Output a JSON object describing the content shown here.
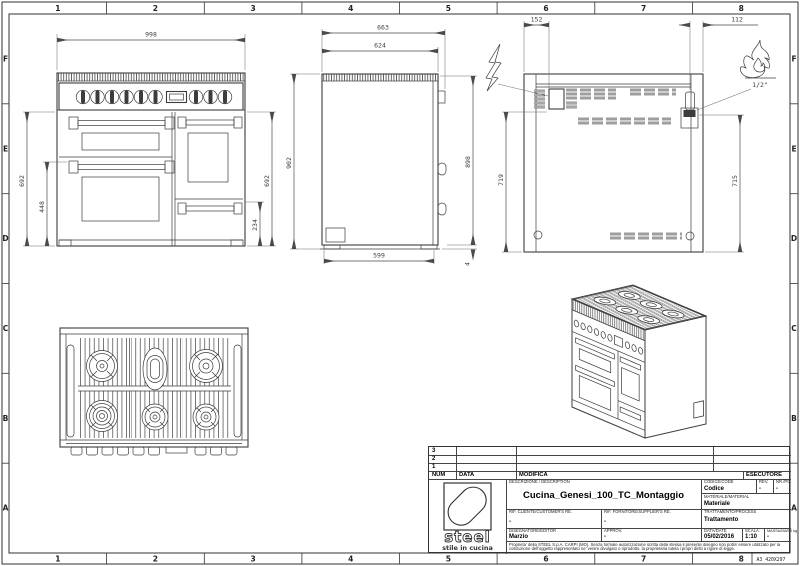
{
  "sheet": {
    "cols": [
      "1",
      "2",
      "3",
      "4",
      "5",
      "6",
      "7",
      "8"
    ],
    "rows": [
      "F",
      "E",
      "D",
      "C",
      "B",
      "A"
    ],
    "format": "A3 420X297"
  },
  "dims": {
    "front": {
      "width": "998",
      "height_left": "692",
      "oven_left": "448",
      "height_right": "692",
      "drawer": "234"
    },
    "side": {
      "depth_total": "663",
      "depth_body": "624",
      "height_total": "902",
      "height_body": "898",
      "base": "599",
      "foot": "4"
    },
    "back": {
      "elec_offset": "152",
      "gas_offset": "112",
      "elec_height": "719",
      "gas_height": "715",
      "gas_thread": "1/2\""
    }
  },
  "titleblock": {
    "rev_rows": [
      "3",
      "2",
      "1"
    ],
    "num_label": "NUM",
    "data_col_label": "DATA",
    "modifica_label": "MODIFICA",
    "esecutore_label": "ESECUTORE",
    "description_label": "DESCRIZIONE / DESCRIPTION",
    "description": "Cucina_Genesi_100_TC_Montaggio",
    "codice_label": "CODICE/CODE",
    "codice": "Codice",
    "rev_label": "REV.",
    "rev": "-",
    "nr_label": "NR./PC.",
    "nr": "-",
    "materiale_label": "MATERIALE/MATERIAL",
    "materiale": "Materiale",
    "rif_cliente_label": "RIF. CLIENTE/CUSTOMER'S RE.",
    "rif_cliente": "-",
    "rif_fornitore_label": "RIF. FORNITORE/SUPPLIER'S RE.",
    "rif_fornitore": "-",
    "trattamento_label": "TRATTAMENTO/PROCESS",
    "trattamento": "Trattamento",
    "disegnatore_label": "DISEGNATORE/EDITOR",
    "disegnatore": "Marzio",
    "approv_label": "APPROV.",
    "approv": "-",
    "date_label": "DATA/DATE",
    "date": "05/02/2016",
    "scala_label": "SCALA",
    "scala": "1:10",
    "massa_label": "MASSA/MASS kg",
    "massa": "-",
    "logo_brand": "steel",
    "logo_tagline": "stile in cucina",
    "disclaimer": "Proprieta' della STEEL S.p.A. CARPI (MO). Senza formale autorizzazione scritta della stessa il presente disegno non potra' essere utilizzato per la costruzione dell'oggetto rappresentato ne' venire divulgato o riprodotto, la proprietaria tutela i propri diritti a rigore di legge.",
    "format": "A3 420X297"
  }
}
